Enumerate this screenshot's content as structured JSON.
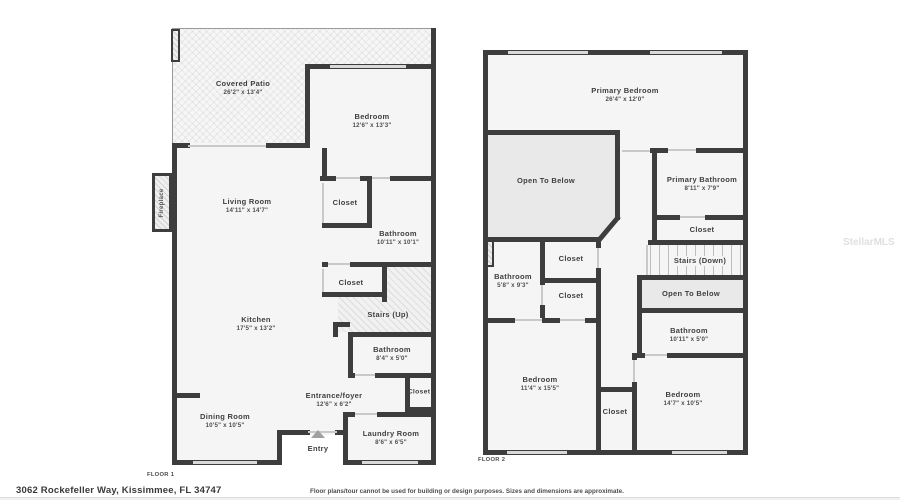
{
  "address": "3062 Rockefeller Way, Kissimmee, FL 34747",
  "disclaimer": "Floor plans/tour cannot be used for building or design purposes. Sizes and dimensions are approximate.",
  "watermark": "StellarMLS",
  "colors": {
    "wall": "#3d3d3d",
    "room_fill": "#f5f5f5",
    "open_fill": "#e9e9e9",
    "window": "#d9d9d9"
  },
  "floor1": {
    "caption": "FLOOR 1",
    "rooms": {
      "covered_patio": {
        "name": "Covered Patio",
        "dims": "26'2\" x 13'4\""
      },
      "bedroom": {
        "name": "Bedroom",
        "dims": "12'6\" x 13'3\""
      },
      "living_room": {
        "name": "Living Room",
        "dims": "14'11\" x 14'7\""
      },
      "closet_a": {
        "name": "Closet"
      },
      "bathroom_a": {
        "name": "Bathroom",
        "dims": "10'11\" x 10'1\""
      },
      "kitchen": {
        "name": "Kitchen",
        "dims": "17'5\" x 13'2\""
      },
      "closet_b": {
        "name": "Closet"
      },
      "stairs": {
        "name": "Stairs (Up)"
      },
      "bathroom_b": {
        "name": "Bathroom",
        "dims": "8'4\" x 5'0\""
      },
      "entrance": {
        "name": "Entrance/foyer",
        "dims": "12'6\" x 6'2\""
      },
      "closet_c": {
        "name": "Closet"
      },
      "dining_room": {
        "name": "Dining Room",
        "dims": "10'5\" x 10'5\""
      },
      "laundry": {
        "name": "Laundry Room",
        "dims": "8'6\" x 6'5\""
      },
      "entry": {
        "name": "Entry"
      },
      "fireplace": {
        "name": "Fireplace"
      }
    }
  },
  "floor2": {
    "caption": "FLOOR 2",
    "rooms": {
      "primary_bedroom": {
        "name": "Primary Bedroom",
        "dims": "26'4\" x 12'0\""
      },
      "open_below_a": {
        "name": "Open To Below"
      },
      "primary_bathroom": {
        "name": "Primary Bathroom",
        "dims": "8'11\" x 7'9\""
      },
      "closet_a": {
        "name": "Closet"
      },
      "stairs": {
        "name": "Stairs (Down)"
      },
      "open_below_b": {
        "name": "Open To Below"
      },
      "bathroom_a": {
        "name": "Bathroom",
        "dims": "5'8\" x 9'3\""
      },
      "closet_b": {
        "name": "Closet"
      },
      "closet_c": {
        "name": "Closet"
      },
      "bathroom_b": {
        "name": "Bathroom",
        "dims": "10'11\" x 5'0\""
      },
      "bedroom_a": {
        "name": "Bedroom",
        "dims": "11'4\" x 15'5\""
      },
      "closet_d": {
        "name": "Closet"
      },
      "bedroom_b": {
        "name": "Bedroom",
        "dims": "14'7\" x 10'5\""
      }
    }
  }
}
